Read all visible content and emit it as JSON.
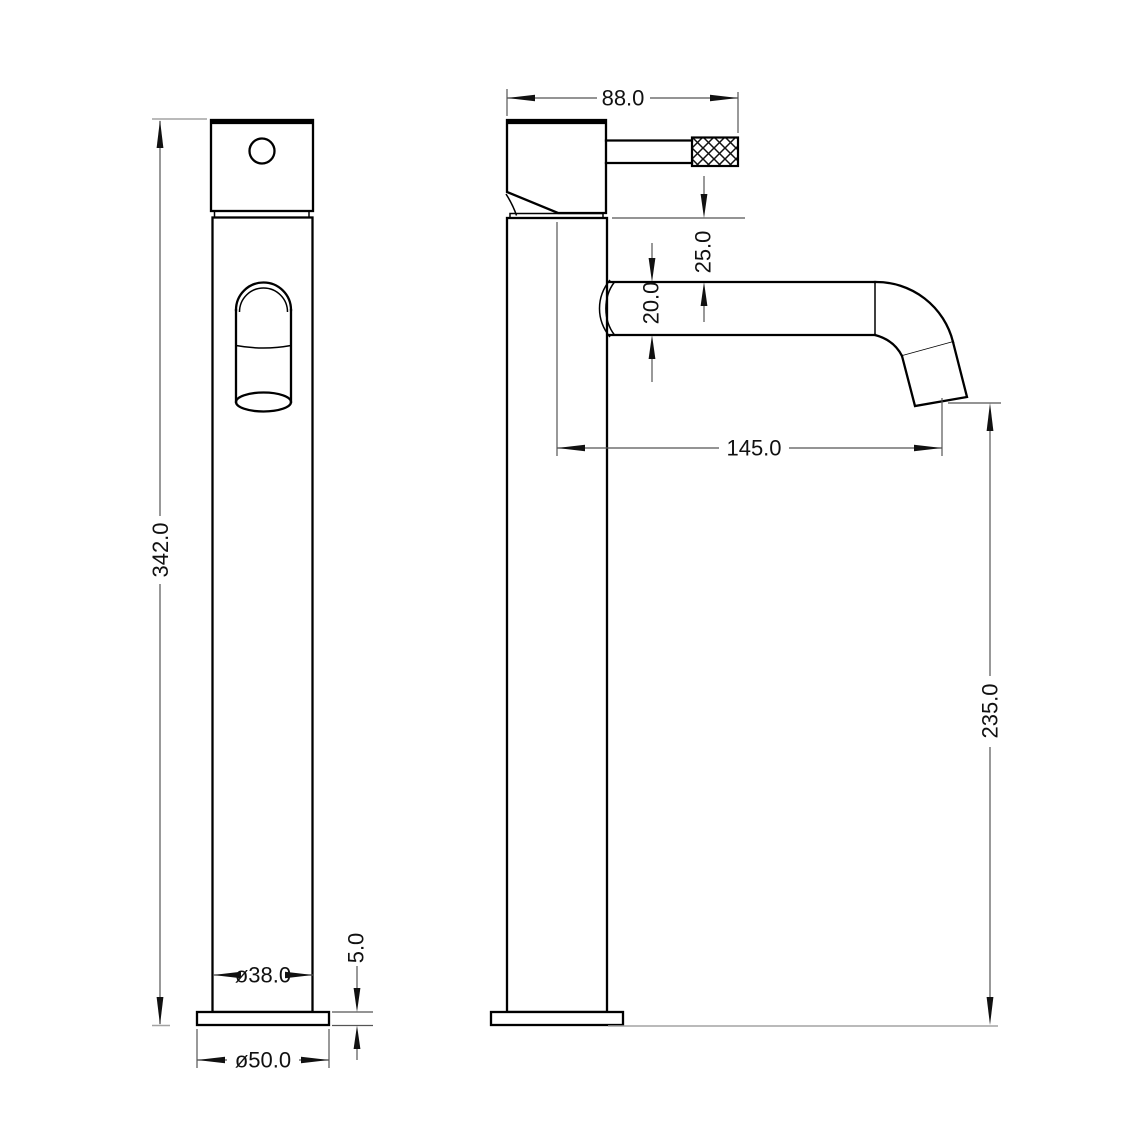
{
  "dimensions": {
    "front_view": {
      "overall_height": "342.0",
      "body_diameter": "ø38.0",
      "base_diameter": "ø50.0",
      "base_thickness": "5.0"
    },
    "side_view": {
      "head_width": "88.0",
      "head_to_spout": "25.0",
      "spout_diameter": "20.0",
      "spout_reach": "145.0",
      "outlet_height": "235.0"
    }
  },
  "colors": {
    "object_line": "#000000",
    "dimension_line": "#555555",
    "extension_line_light": "#a3a3a3",
    "text": "#111111",
    "background": "#ffffff"
  }
}
